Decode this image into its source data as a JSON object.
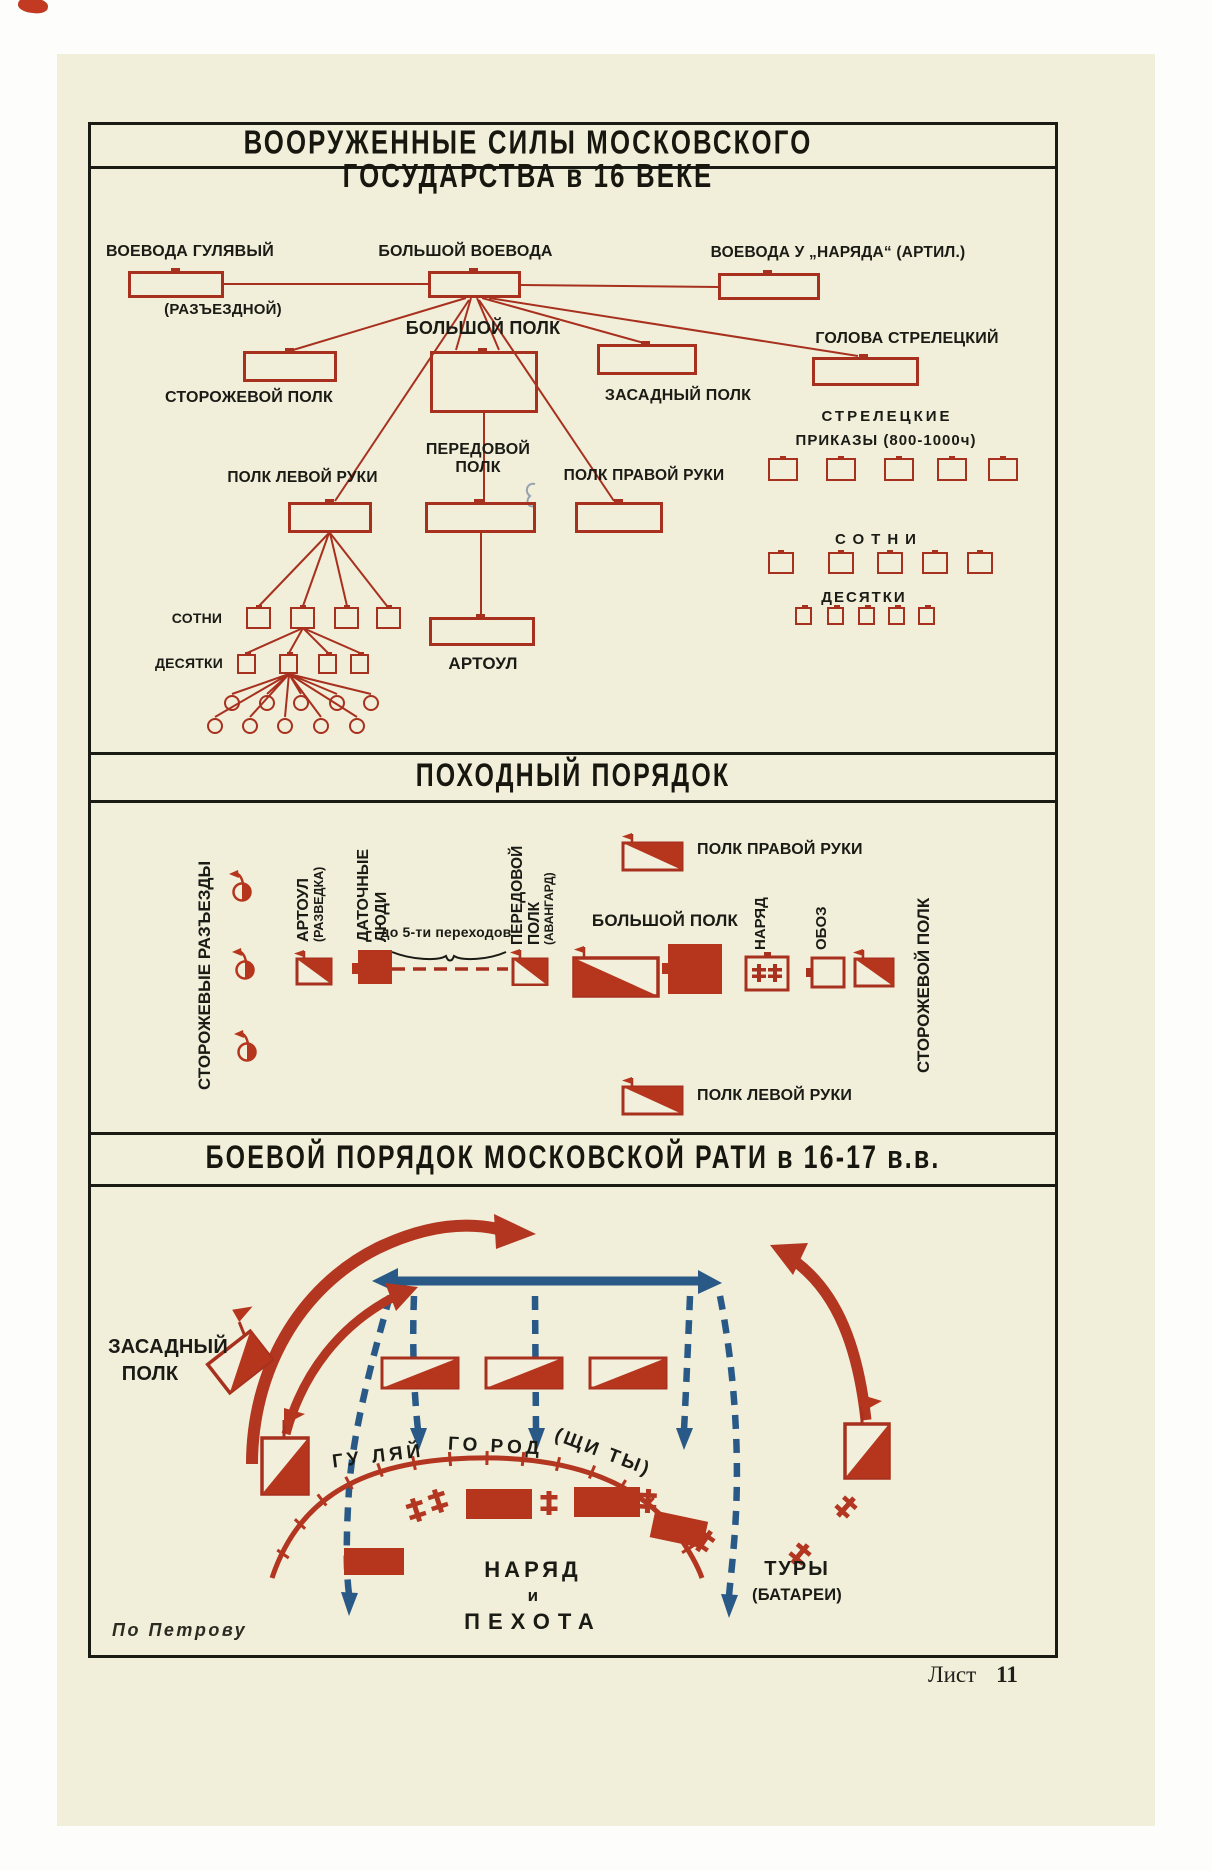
{
  "colors": {
    "paper": "#f1eeda",
    "ink": "#1b1b15",
    "red_outline": "#a7311e",
    "red_solid": "#b5351d",
    "blue": "#295a87"
  },
  "frame": {
    "title": "ВООРУЖЕННЫЕ СИЛЫ МОСКОВСКОГО ГОСУДАРСТВА в 16 ВЕКЕ"
  },
  "org": {
    "voevoda_gulyavy": "ВОЕВОДА ГУЛЯВЫЙ",
    "razyezdnoy": "(РАЗЪЕЗДНОЙ)",
    "bolshoy_voevoda": "БОЛЬШОЙ ВОЕВОДА",
    "voevoda_u_naryada": "ВОЕВОДА У „НАРЯДА“ (АРТИЛ.)",
    "bolshoy_polk": "БОЛЬШОЙ ПОЛК",
    "storozhevoy_polk": "СТОРОЖЕВОЙ ПОЛК",
    "zasadny_polk": "ЗАСАДНЫЙ ПОЛК",
    "golova_streletsky": "ГОЛОВА СТРЕЛЕЦКИЙ",
    "peredovoy_1": "ПЕРЕДОВОЙ",
    "peredovoy_2": "ПОЛК",
    "polk_levoy_ruki": "ПОЛК ЛЕВОЙ РУКИ",
    "polk_pravoy_ruki": "ПОЛК ПРАВОЙ РУКИ",
    "streletskie_1": "СТРЕЛЕЦКИЕ",
    "streletskie_2": "ПРИКАЗЫ (800-1000ч)",
    "sotni_left": "СОТНИ",
    "desyatki_left": "ДЕСЯТКИ",
    "sotni_right": "СОТНИ",
    "desyatki_right": "ДЕСЯТКИ",
    "artoul": "АРТОУЛ"
  },
  "march": {
    "title": "ПОХОДНЫЙ ПОРЯДОК",
    "storozhevye_razyezdy": "СТОРОЖЕВЫЕ РАЗЪЕЗДЫ",
    "artoul": "АРТОУЛ",
    "artoul_note": "(РАЗВЕДКА)",
    "datochnye_1": "ДАТОЧНЫЕ",
    "datochnye_2": "ЛЮДИ",
    "perekhody": "до 5-ти переходов",
    "peredovoy_1": "ПЕРЕДОВОЙ",
    "peredovoy_2": "ПОЛК",
    "peredovoy_note": "(АВАНГАРД)",
    "bolshoy_polk": "БОЛЬШОЙ ПОЛК",
    "polk_pravoy_ruki": "ПОЛК ПРАВОЙ РУКИ",
    "polk_levoy_ruki": "ПОЛК ЛЕВОЙ РУКИ",
    "naryad": "НАРЯД",
    "oboz": "ОБОЗ",
    "storozhevoy_polk": "СТОРОЖЕВОЙ ПОЛК"
  },
  "battle": {
    "title": "БОЕВОЙ ПОРЯДОК МОСКОВСКОЙ РАТИ  в  16-17 в.в.",
    "zasadny_1": "ЗАСАДНЫЙ",
    "zasadny_2": "ПОЛК",
    "gulyay_1": "ГУ ЛЯЙ",
    "gulyay_2": "ГО РОД",
    "gulyay_3": "(ЩИ ТЫ)",
    "naryad": "НАРЯД",
    "i": "и",
    "pekhota": "ПЕХОТА",
    "tury": "ТУРЫ",
    "batarei": "(БАТАРЕИ)"
  },
  "footer": {
    "credit": "По Петрову",
    "sheet_word": "Лист",
    "sheet_number": "11"
  },
  "icons": {
    "regiment_flag_icon": "square with diagonal red half and pennant",
    "infantry_square_icon": "solid red square",
    "scout_icon": "half-filled circle with pennant",
    "cannon_icon": "red double-cross artillery mark",
    "naryad_box_icon": "outlined box with cannon marks",
    "oboz_box_icon": "outlined square",
    "enemy_line_icon": "thick blue bar with arrowheads",
    "retreat_arrow_icon": "blue dashed arrow",
    "envelopment_arrow_icon": "red curved arrow"
  }
}
